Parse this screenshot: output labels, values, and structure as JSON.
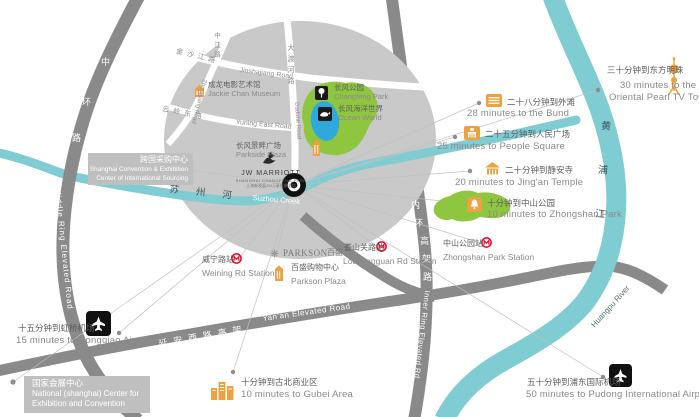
{
  "colors": {
    "river": "#7fccd2",
    "road": "#8a8a8a",
    "circle": "#c9c9c9",
    "park_green": "#8fc640",
    "lake_blue": "#2fa8dd",
    "poi_orange": "#eea23f",
    "metro_red": "#e60021",
    "text_gray": "#5f5f5f",
    "river_text": "#37565a"
  },
  "hotel": {
    "name": "JW MARRIOTT",
    "subtitle": "SHANGHAI CHANGFENG PARK",
    "cn": "上海新发展JW万豪侯爵酒店"
  },
  "inset": {
    "roads": {
      "zhongjiang": {
        "cn": "中江路",
        "en": "Zhongjiang Road"
      },
      "jinshajiang": {
        "cn": "金沙江路",
        "en": "Jinshajiang Road"
      },
      "daduhe": {
        "cn": "大渡河路",
        "en": "Daduhe Road"
      },
      "yuning": {
        "cn": "云岭东路",
        "en": "Yuning East Road"
      }
    },
    "pois": {
      "jackie_chan": {
        "cn": "成龙电影艺术馆",
        "en": "Jackie Chan Museum"
      },
      "changfeng_park": {
        "cn": "长风公园",
        "en": "Changfeng Park"
      },
      "ocean_world": {
        "cn": "长风海洋世界",
        "en": "Ocean World"
      },
      "parkside_plaza": {
        "cn": "长风景畔广场",
        "en": "Parkside Plaza"
      }
    }
  },
  "roads": {
    "middle_ring": {
      "cn": [
        "中",
        "环",
        "路"
      ],
      "en": "Middle Ring Elevated Road"
    },
    "inner_ring": {
      "cn": [
        "内",
        "环",
        "高",
        "架",
        "路"
      ],
      "en": "Inner Ring Elevated Rd"
    },
    "yanan": {
      "cn": "延安西路高架",
      "en": "Yan'an Elevated Road"
    }
  },
  "rivers": {
    "suzhou": {
      "cn": "苏州河",
      "en": "Suzhou Creek"
    },
    "huangpu": {
      "cn": "黄浦江",
      "en": "Huangpu River"
    }
  },
  "destinations": {
    "oriental_pearl": {
      "cn": "三十分钟到东方明珠",
      "en1": "30 minutes to the",
      "en2": "Oriental Pearl TV Tower"
    },
    "bund": {
      "cn": "二十八分钟到外滩",
      "en": "28 minutes to the Bund"
    },
    "people_square": {
      "cn": "二十五分钟到人民广场",
      "en": "25 minutes to People Square"
    },
    "jingan": {
      "cn": "二十分钟到静安寺",
      "en": "20 minutes to Jing'an Temple"
    },
    "zhongshan_park": {
      "cn": "十分钟到中山公园",
      "en": "10 minutes to Zhongshan Park"
    },
    "gubei": {
      "cn": "十分钟到古北商业区",
      "en": "10 minutes to Gubei Area"
    },
    "hongqiao": {
      "cn": "十五分钟到虹桥机场",
      "en": "15 minutes to Hongqiao Airport"
    },
    "pudong": {
      "cn": "五十分钟到浦东国际机场",
      "en": "50 minutes to Pudong International Airport"
    }
  },
  "stations": {
    "weining": {
      "cn": "威宁路站",
      "en": "Weining Rd Station"
    },
    "loushanguan": {
      "cn": "娄山关路站",
      "en": "Loushanguan Rd Station"
    },
    "zhongshan": {
      "cn": "中山公园站",
      "en": "Zhongshan Park Station"
    }
  },
  "places": {
    "parkson": {
      "logo": "PARKSON",
      "logo_cn": "百盛",
      "cn": "百盛购物中心",
      "en": "Parkson Plaza"
    },
    "sourcing_center": {
      "cn": "跨国采购中心",
      "en1": "Shanghai Convention & Exhibition",
      "en2": "Center of International Sourcing"
    },
    "national_center": {
      "cn": "国家会展中心",
      "en1": "National (shanghai) Center for",
      "en2": "Exhibition and Convention"
    }
  }
}
